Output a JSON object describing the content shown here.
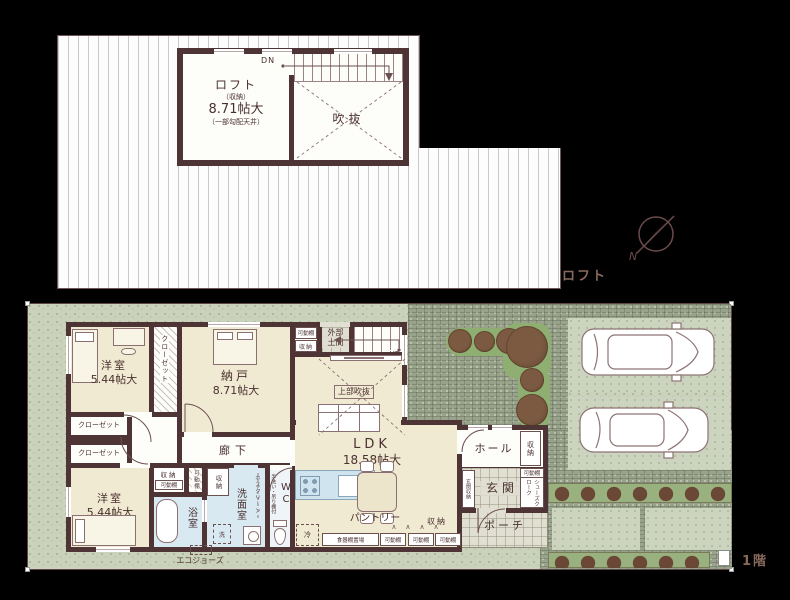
{
  "floor_tags": {
    "loft": "ロフト",
    "first": "1階"
  },
  "compass": {
    "north": "N"
  },
  "loft_plan": {
    "room": {
      "name": "ロフト",
      "sub": "（収納）",
      "size": "8.71帖大",
      "note": "（一部勾配天井）"
    },
    "void_label": "吹抜",
    "down": "DN"
  },
  "plan1f": {
    "yoshitsu1": {
      "name": "洋室",
      "size": "5.44帖大"
    },
    "yoshitsu2": {
      "name": "洋室",
      "size": "5.44帖大"
    },
    "nando": {
      "name": "納戸",
      "size": "8.71帖大"
    },
    "ldk": {
      "name": "LDK",
      "size": "18.58帖大"
    },
    "closet": "クローゼット",
    "hallway": "廊下",
    "hall": "ホール",
    "entrance": "玄関",
    "entrance_storage": "玄関収納",
    "shoes_cloak": "シューズクローク",
    "porch": "ポーチ",
    "bath": "浴室",
    "washroom": "洗面室",
    "wc": "WC",
    "wc_note": "手洗い・吊り棚付",
    "outer_doma_1": "外部",
    "outer_doma_2": "土間",
    "void_above": "上部吹抜",
    "up": "UP",
    "pantry": "パントリー",
    "cupboard_place": "食器棚置場",
    "fridge": "冷",
    "washer": "洗",
    "hoscreen": "ホスクリーン",
    "storage": "収納",
    "movable_shelf": "可動棚",
    "eco_jozu": "エコジョーズ",
    "shelf_marks": "∧    ∧    ∧    ∧"
  },
  "colors": {
    "wall": "#4e3434",
    "room_cream": "#f1ead2",
    "wet_aqua": "#d8e9f2",
    "site_green": "#cad2bc",
    "paving": "#99a38c",
    "hedge_green": "#98b17f",
    "accent_text": "#8a6a5e",
    "background": "#000000"
  }
}
